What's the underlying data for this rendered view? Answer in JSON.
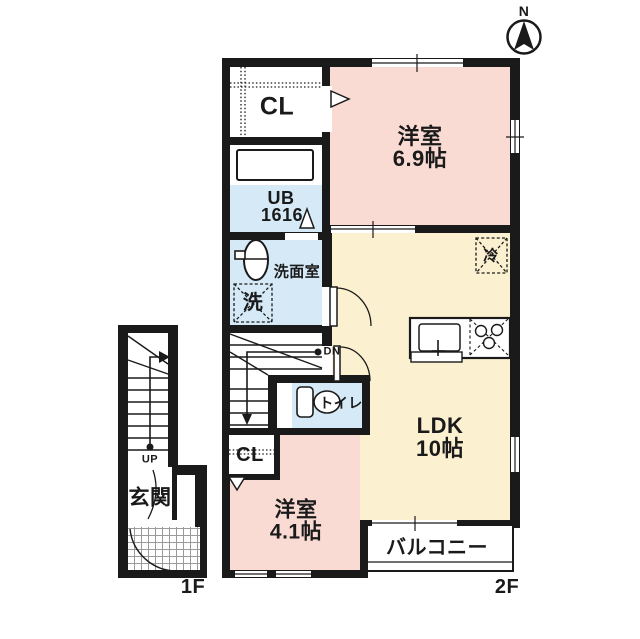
{
  "colors": {
    "wall": "#1a1a1a",
    "room_pink": "#fadbd4",
    "room_yellow": "#fbf0d0",
    "room_blue": "#d5eaf6",
    "tile_line": "#9a9a9a"
  },
  "compass": {
    "label": "N"
  },
  "floor2": {
    "floor_label": "2F",
    "closet_top_label": "CL",
    "bath_label_1": "UB",
    "bath_label_2": "1616",
    "washroom_label": "洗面室",
    "washer_label": "洗",
    "room_69_label_1": "洋室",
    "room_69_label_2": "6.9帖",
    "fridge_label": "冷",
    "stairs_down_label": "DN",
    "toilet_label": "トイレ",
    "closet_bottom_label": "CL",
    "room_41_label_1": "洋室",
    "room_41_label_2": "4.1帖",
    "ldk_label_1": "LDK",
    "ldk_label_2": "10帖",
    "balcony_label": "バルコニー"
  },
  "floor1": {
    "floor_label": "1F",
    "entrance_label": "玄関",
    "stairs_up_label": "UP"
  }
}
